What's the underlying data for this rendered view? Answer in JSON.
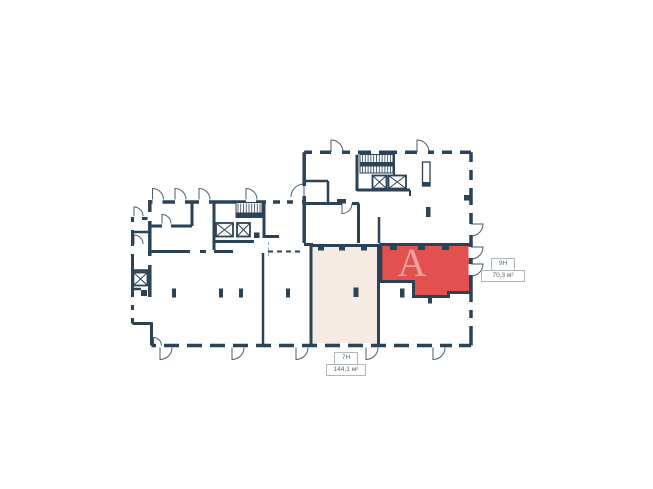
{
  "page": {
    "background_color": "#ffffff"
  },
  "colors": {
    "wall": "#2c4257",
    "unit_highlight_fill": "#e25150",
    "unit_secondary_fill": "#f6eae5",
    "label_border": "#b3b8bc",
    "label_text": "#5a6a76",
    "boundary_dash": "#9aa7b0",
    "watermark": "#ffffff"
  },
  "plan": {
    "type": "floor-plan",
    "units": [
      {
        "id": "9Н",
        "area": "70,3 м²",
        "state": "selected-highlight"
      },
      {
        "id": "7Н",
        "area": "144,1 м²",
        "state": "secondary-highlight"
      }
    ]
  },
  "watermark": {
    "text": "А"
  }
}
